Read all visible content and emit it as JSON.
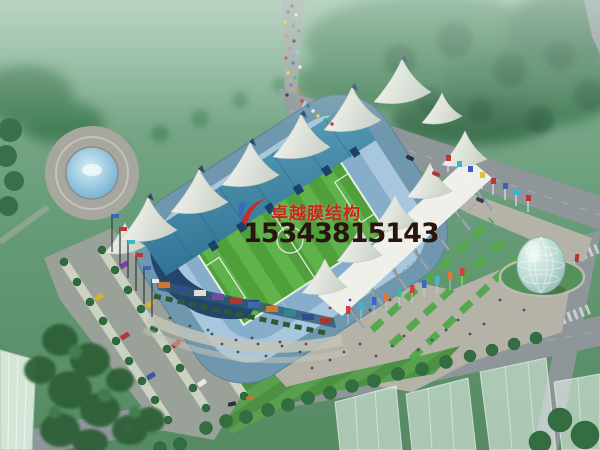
{
  "watermark": {
    "company_name": "卓越膜结构",
    "phone_number": "15343815143"
  },
  "palette": {
    "brand-red": "#c5281e",
    "phone-dark": "#2a1410",
    "grass-green": "#6aa078",
    "pitch-green": "#4f9f3a",
    "pitch-green-light": "#60b24b",
    "roof-teal": "#3f7f9e",
    "membrane-white": "#eef0e9",
    "seat-blue": "#a8c7de",
    "road-grey": "#8e9699",
    "plaza-grey": "#b5b3a8",
    "water-blue": "#5aa0c8"
  }
}
